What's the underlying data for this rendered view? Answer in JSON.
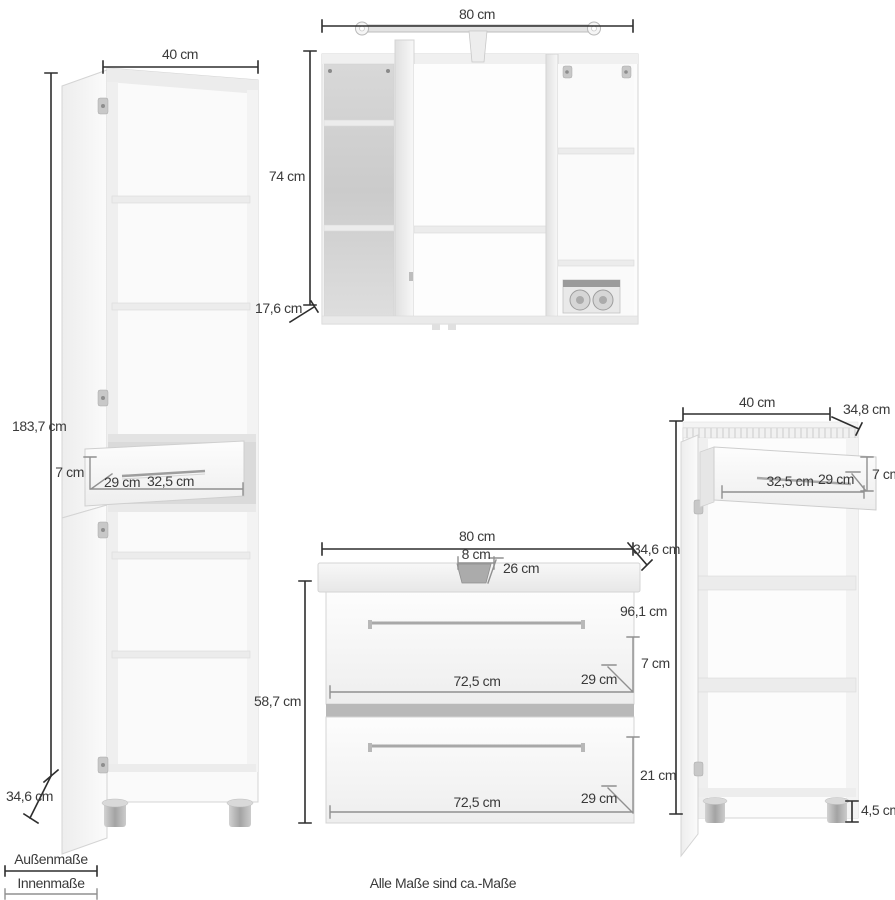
{
  "footnote": "Alle Maße sind ca.-Maße",
  "legend": {
    "outer_label": "Außenmaße",
    "inner_label": "Innenmaße"
  },
  "colors": {
    "outer_dim_line": "#2e2e2e",
    "inner_dim_line": "#909090",
    "label_text": "#3a3a3a",
    "furniture_edge": "#d4d4d4"
  },
  "tall_cabinet": {
    "width": "40 cm",
    "height": "183,7 cm",
    "depth": "34,6 cm",
    "drawer": {
      "inner_height": "7 cm",
      "inner_depth": "29 cm",
      "inner_width": "32,5 cm"
    }
  },
  "mirror_cabinet": {
    "width": "80 cm",
    "height": "74 cm",
    "depth": "17,6 cm"
  },
  "vanity_cabinet": {
    "width": "80 cm",
    "height": "58,7 cm",
    "depth": "34,6 cm",
    "siphon_cutout": {
      "width": "8 cm",
      "depth": "26 cm"
    },
    "drawer_top": {
      "inner_width": "72,5 cm",
      "inner_depth": "29 cm",
      "inner_height": "7 cm"
    },
    "drawer_bottom": {
      "inner_width": "72,5 cm",
      "inner_depth": "29 cm",
      "inner_height": "21 cm"
    }
  },
  "side_cabinet": {
    "width": "40 cm",
    "height": "96,1 cm",
    "depth": "34,8 cm",
    "drawer": {
      "inner_width": "32,5 cm",
      "inner_depth": "29 cm",
      "inner_height": "7 cm"
    },
    "foot_height": "4,5 cm"
  }
}
